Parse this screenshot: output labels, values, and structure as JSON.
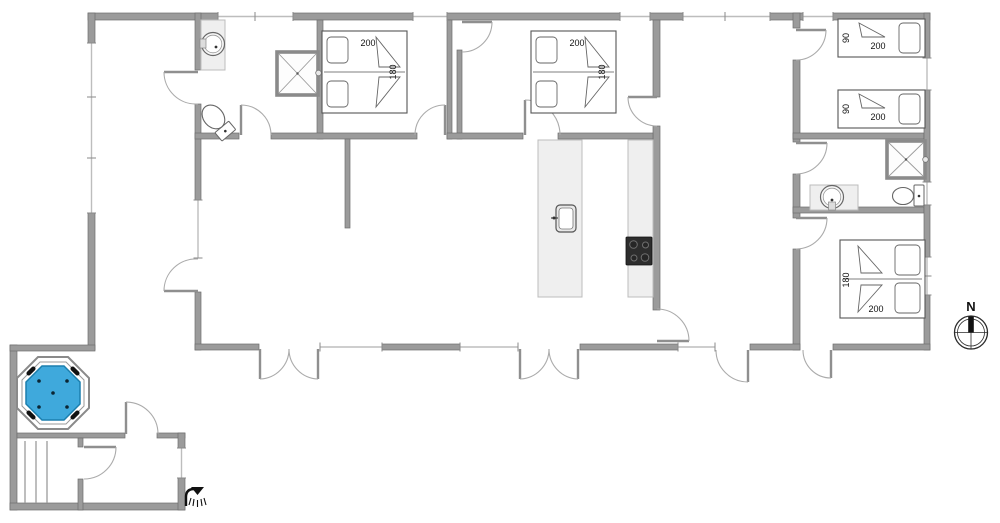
{
  "plan": {
    "compass_label": "N",
    "colors": {
      "wall": "#9b9b9b",
      "hot_tub_water": "#3FA9DC",
      "hot_tub_rim": "#8a8a8a",
      "stove": "#2d2d2d"
    },
    "beds": {
      "bedroom1_double": {
        "length": "200",
        "width": "180"
      },
      "bedroom2_double": {
        "length": "200",
        "width": "180"
      },
      "single_top": {
        "width": "90",
        "length": "200"
      },
      "single_bottom": {
        "width": "90",
        "length": "200"
      },
      "bedroom4_double": {
        "width": "180",
        "length": "200"
      }
    }
  }
}
